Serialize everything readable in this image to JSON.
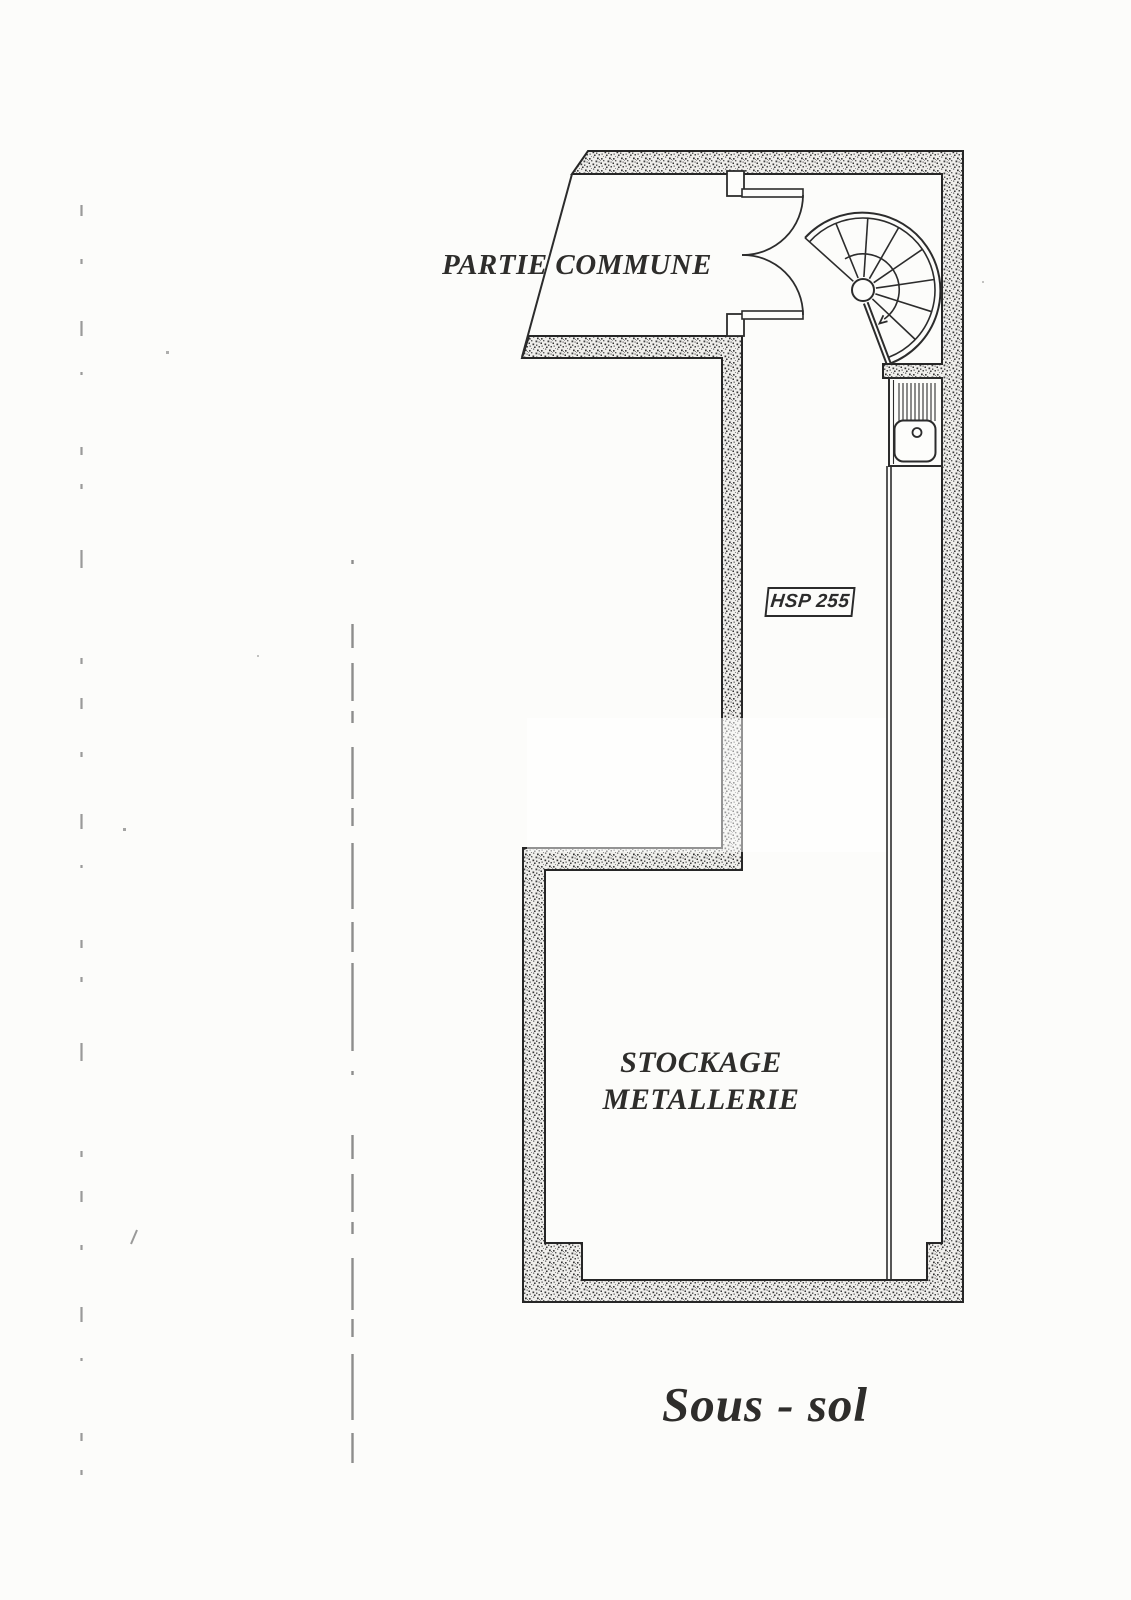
{
  "plan": {
    "title": "Sous - sol",
    "labels": {
      "partie_commune": "PARTIE COMMUNE",
      "stockage_line1": "STOCKAGE",
      "stockage_line2": "METALLERIE",
      "hsp": "HSP 255"
    },
    "colors": {
      "ink": "#262626",
      "paper": "#fcfcfa",
      "wall_fill_base": "#efeeeb",
      "text": "#2e2d2b"
    }
  }
}
